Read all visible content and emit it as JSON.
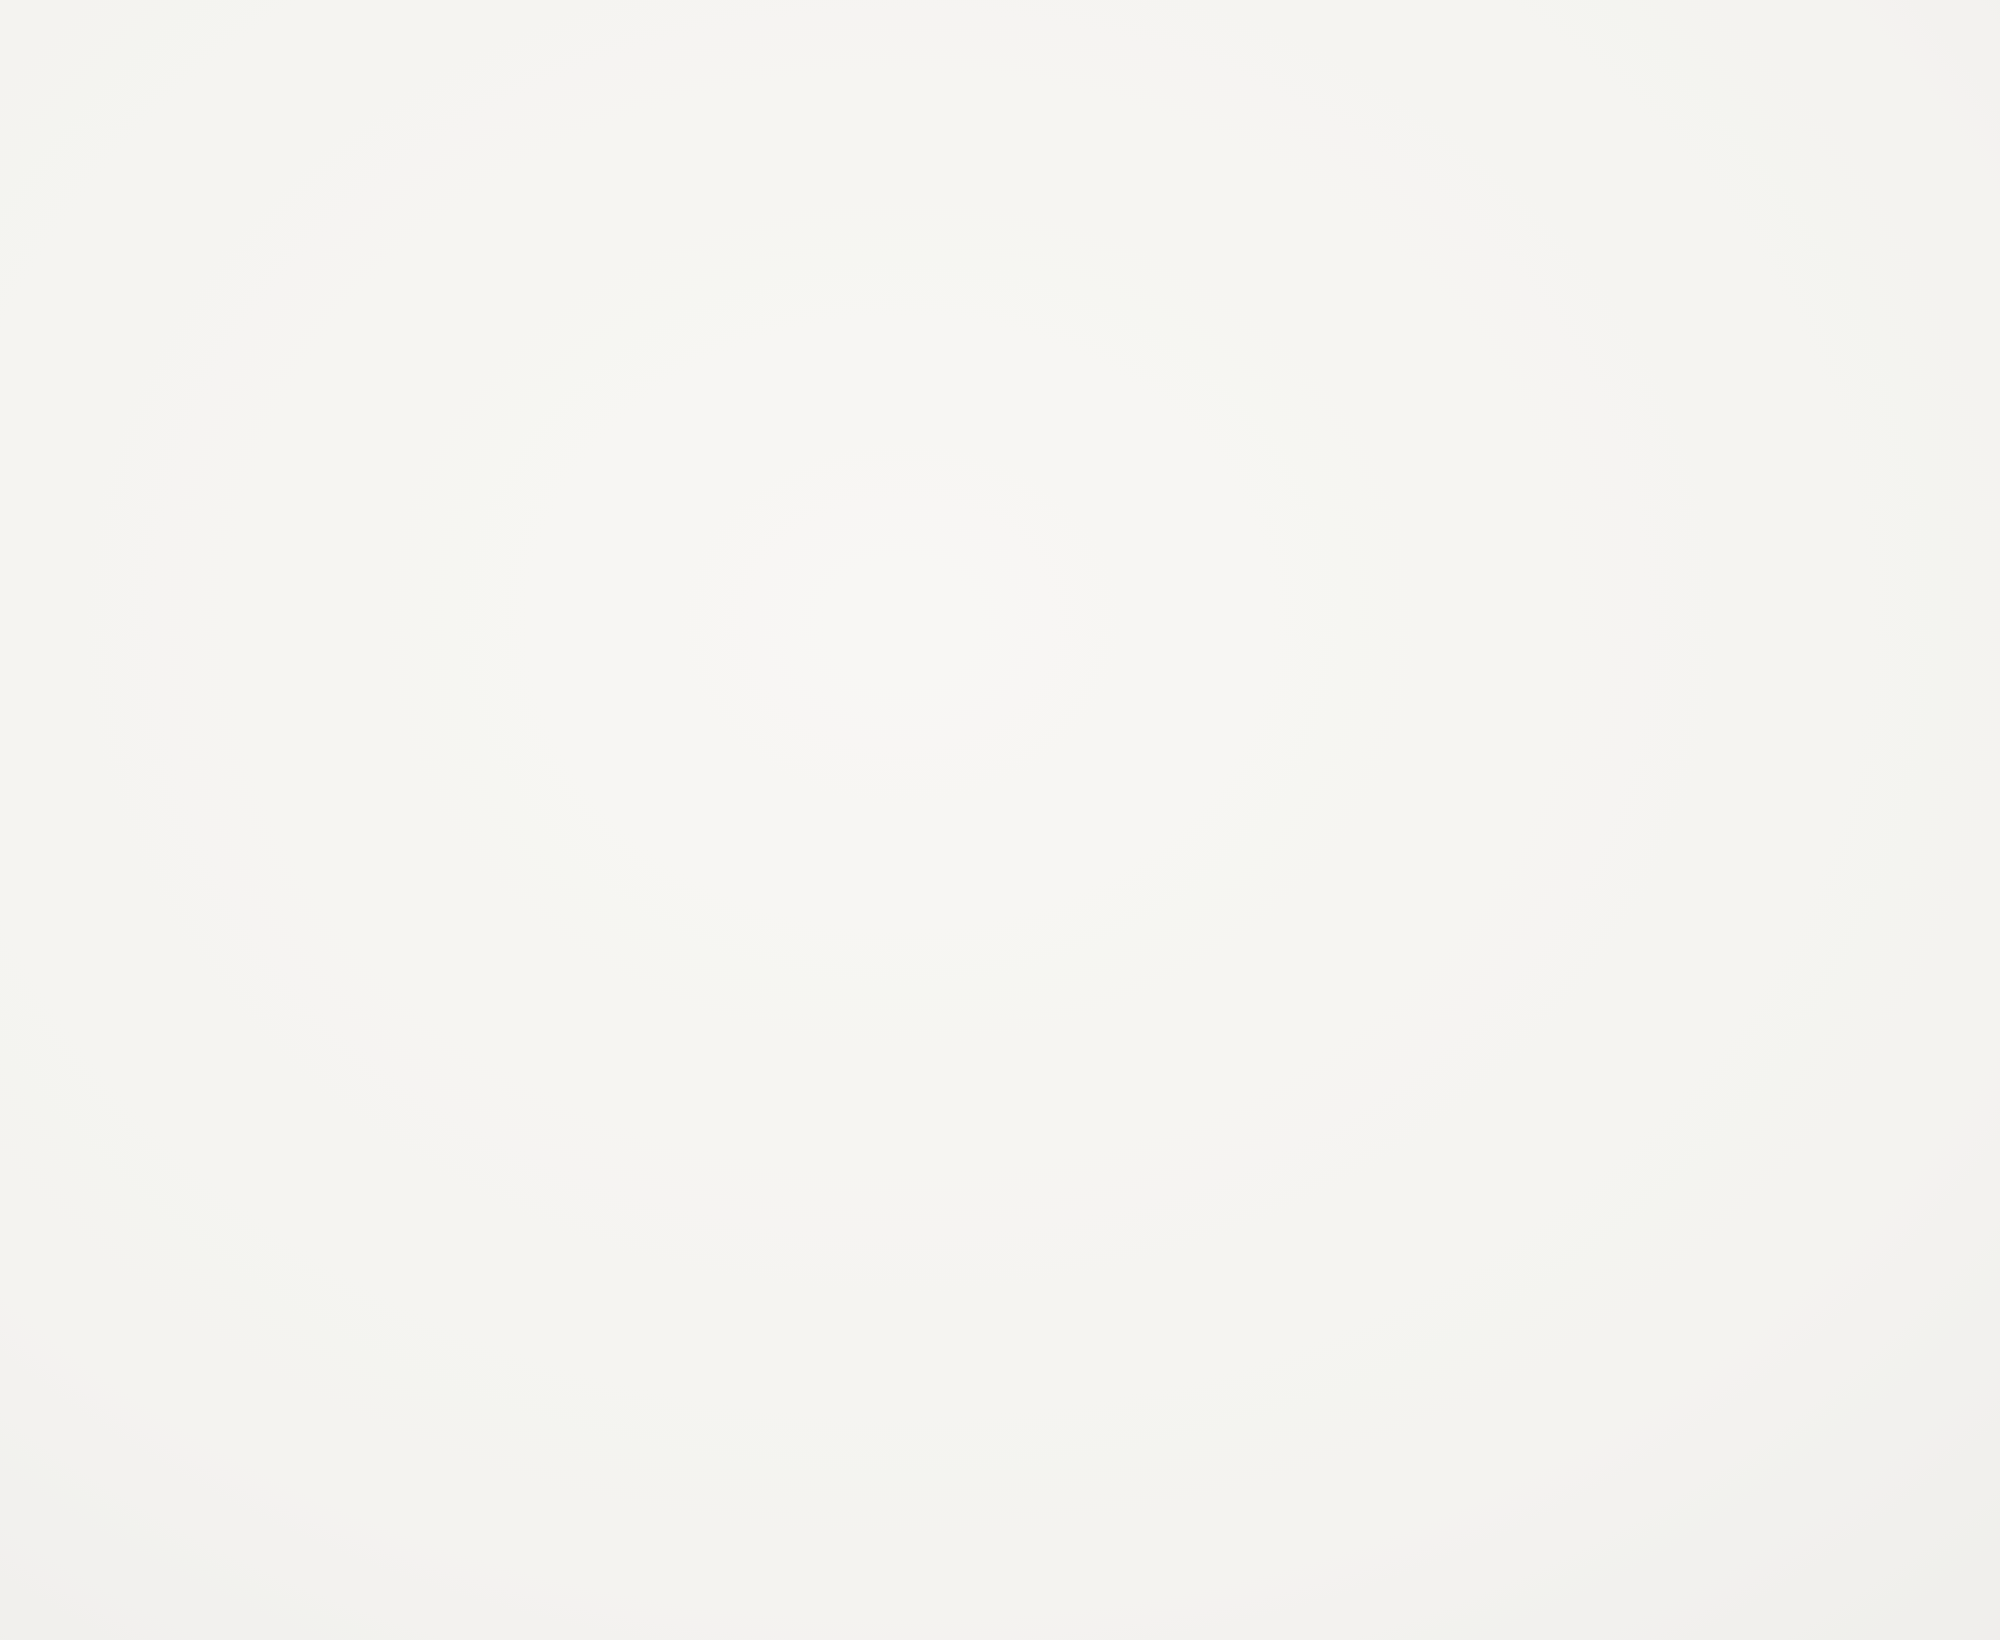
{
  "document": {
    "title": "Hand-drawn front elevation sketch of a French country style house",
    "medium": "graphite pencil with black ink marker accents on white drawing paper",
    "visible_text": []
  },
  "palette": {
    "paper": "#f5f4f1",
    "paper_light": "#f8f7f5",
    "pencil_dark": "#383838",
    "pencil": "#4e4e4e",
    "pencil_light": "#7b7b79",
    "pencil_faint": "#aeaaa6",
    "ink": "#161616",
    "smudge": "#dddcd9"
  },
  "roof": {
    "ridge": {
      "x1": 933,
      "y": 432,
      "x2": 1086,
      "faint_x2": 1228
    },
    "edges": [
      [
        933,
        435,
        688,
        886,
        "m"
      ],
      [
        941,
        440,
        698,
        890,
        "m"
      ],
      [
        521,
        506,
        66,
        936,
        "m"
      ],
      [
        531,
        511,
        78,
        941,
        "m"
      ],
      [
        312,
        646,
        404,
        646,
        "m"
      ],
      [
        312,
        646,
        172,
        834,
        "m"
      ],
      [
        321,
        651,
        183,
        839,
        "l"
      ],
      [
        172,
        834,
        104,
        922,
        "l"
      ],
      [
        520,
        504,
        908,
        504,
        "m"
      ],
      [
        1086,
        433,
        1232,
        657,
        "m"
      ],
      [
        1232,
        657,
        1327,
        803,
        "l"
      ],
      [
        1228,
        433,
        1680,
        948,
        "l"
      ],
      [
        1447,
        658,
        1277,
        950,
        "m"
      ],
      [
        1447,
        658,
        1659,
        658,
        "m"
      ],
      [
        1659,
        658,
        1930,
        941,
        "m"
      ],
      [
        1570,
        800,
        1623,
        906,
        "l"
      ],
      [
        1757,
        795,
        1799,
        906,
        "l"
      ],
      [
        1512,
        760,
        1552,
        905,
        "l"
      ],
      [
        876,
        500,
        756,
        720,
        "l"
      ],
      [
        840,
        565,
        735,
        760,
        "l"
      ],
      [
        1005,
        470,
        1128,
        660,
        "l"
      ],
      [
        1040,
        525,
        1155,
        700,
        "l"
      ],
      [
        640,
        680,
        430,
        888,
        "l"
      ]
    ],
    "planes": {
      "left": {
        "clip": [
          [
            40,
            945
          ],
          [
            520,
            500
          ],
          [
            945,
            428
          ],
          [
            700,
            890
          ],
          [
            420,
            945
          ]
        ],
        "y1": 505,
        "y2": 938,
        "step": 57,
        "x1": 30,
        "x2": 960
      },
      "center": {
        "clip": [
          [
            688,
            890
          ],
          [
            935,
            432
          ],
          [
            1088,
            432
          ],
          [
            1234,
            662
          ],
          [
            1152,
            955
          ],
          [
            618,
            955
          ]
        ],
        "y1": 466,
        "y2": 948,
        "step": 54,
        "x1": 600,
        "x2": 1250
      },
      "rightback": {
        "clip": [
          [
            1088,
            430
          ],
          [
            1228,
            433
          ],
          [
            1930,
            941
          ],
          [
            1662,
            950
          ],
          [
            1232,
            662
          ]
        ],
        "y1": 470,
        "y2": 944,
        "step": 56,
        "x1": 1080,
        "x2": 1935
      },
      "rightwing": {
        "clip": [
          [
            1447,
            660
          ],
          [
            1659,
            660
          ],
          [
            1930,
            943
          ],
          [
            1280,
            952
          ]
        ],
        "y1": 678,
        "y2": 938,
        "step": 50,
        "x1": 1270,
        "x2": 1935
      }
    }
  },
  "eaves": {
    "lines": [
      [
        58,
        936,
        560,
        936,
        "m"
      ],
      [
        58,
        948,
        560,
        948,
        "m"
      ],
      [
        52,
        928,
        92,
        928,
        "l"
      ],
      [
        52,
        928,
        52,
        950,
        "l"
      ],
      [
        1067,
        940,
        1930,
        940,
        "m"
      ],
      [
        1067,
        952,
        1930,
        952,
        "m"
      ],
      [
        1930,
        940,
        1937,
        963,
        "m"
      ],
      [
        618,
        850,
        1085,
        850,
        "m"
      ],
      [
        618,
        872,
        1085,
        872,
        "m"
      ],
      [
        600,
        890,
        1085,
        890,
        "f"
      ]
    ],
    "stringcourse_tick_segments": [
      [
        620,
        664
      ],
      [
        746,
        790
      ],
      [
        874,
        922
      ],
      [
        1006,
        1083
      ]
    ],
    "corners": [
      [
        66,
        950,
        66,
        1120,
        1.5
      ],
      [
        560,
        948,
        560,
        1100,
        1.5
      ],
      [
        1082,
        888,
        1082,
        1160,
        1.5
      ],
      [
        1686,
        954,
        1686,
        1205,
        2.0
      ],
      [
        1692,
        954,
        1692,
        1205,
        1.0
      ],
      [
        1910,
        954,
        1910,
        1198,
        2.0
      ],
      [
        1918,
        954,
        1918,
        1196,
        1.1
      ],
      [
        618,
        852,
        618,
        938,
        1.0
      ]
    ]
  },
  "dormers": [
    {
      "name": "left-wing-dormer",
      "cx": 332,
      "peak": 845,
      "spring": 900,
      "base": 958,
      "w": 96,
      "win": 56,
      "block": false
    },
    {
      "name": "center-dormer-1",
      "cx": 705,
      "peak": 772,
      "spring": 815,
      "base": 905,
      "w": 80,
      "win": 50,
      "block": true
    },
    {
      "name": "center-dormer-2",
      "cx": 831,
      "peak": 772,
      "spring": 815,
      "base": 905,
      "w": 80,
      "win": 50,
      "block": true
    },
    {
      "name": "center-dormer-3",
      "cx": 964,
      "peak": 772,
      "spring": 815,
      "base": 905,
      "w": 80,
      "win": 50,
      "block": true
    },
    {
      "name": "right-dormer",
      "cx": 1150,
      "peak": 845,
      "spring": 900,
      "base": 958,
      "w": 96,
      "win": 56,
      "block": false
    }
  ],
  "windows": [
    {
      "name": "left-wing-window",
      "frame": [
        197,
        985,
        102,
        157
      ],
      "cols": 4,
      "rows": 3,
      "header": [
        197,
        963,
        102,
        22
      ],
      "shutters": [
        [
          150,
          985,
          46,
          165,
          -1
        ],
        [
          300,
          985,
          46,
          165,
          1
        ]
      ],
      "sill": true
    },
    {
      "name": "right-center-window",
      "frame": [
        1150,
        988,
        106,
        160
      ],
      "cols": 4,
      "rows": 3,
      "header": [
        1150,
        965,
        106,
        23
      ],
      "shutters": [
        [
          1103,
          990,
          45,
          162,
          -1
        ],
        [
          1258,
          990,
          45,
          162,
          1
        ]
      ],
      "sill": true
    },
    {
      "name": "right-wing-window",
      "frame": [
        1528,
        982,
        70,
        168
      ],
      "cols": 2,
      "rows": 3,
      "header": [
        1528,
        960,
        70,
        22
      ],
      "shutters": [
        [
          1488,
          984,
          38,
          168,
          -1
        ],
        [
          1600,
          984,
          38,
          168,
          1
        ]
      ],
      "sill": true,
      "hinges": true
    },
    {
      "name": "far-right-window",
      "frame": [
        1757,
        965,
        63,
        120
      ],
      "cols": 2,
      "rows": 2,
      "header": [
        1757,
        945,
        63,
        20
      ],
      "shutters": [],
      "sill": true
    }
  ],
  "arch_window": {
    "name": "grand-arched-window",
    "band_out": [
      420,
      774,
      1010,
      878
    ],
    "band_in": [
      446,
      748,
      1010,
      905
    ],
    "x1": 440,
    "x2": 754,
    "spring": 1010,
    "bottom": 1235,
    "cols": [
      452,
      528,
      604,
      680
    ],
    "pane_w": 62,
    "rows": [
      [
        1047,
        1105
      ],
      [
        1117,
        1172
      ],
      [
        1184,
        1232
      ]
    ],
    "r1_tops": [
      992,
      958,
      958,
      992
    ],
    "r1_bottom": 1035,
    "shutters": [
      [
        380,
        1012,
        42,
        168,
        -1
      ],
      [
        774,
        1012,
        62,
        173,
        1
      ]
    ],
    "construction": [
      [
        376,
        1180,
        520,
        930
      ],
      [
        700,
        1140,
        800,
        980
      ]
    ]
  },
  "door": {
    "name": "entry-door",
    "fan_out": [
      897,
      1035,
      1010,
      928
    ],
    "fan_in": [
      920,
      1012,
      1010,
      962
    ],
    "frame_x1": 922,
    "frame_x2": 1005,
    "spring": 1012,
    "head_crown": 980,
    "bottom": 1185,
    "leaf_x1": 933,
    "leaf_x2": 996,
    "cols": [
      938,
      968
    ],
    "pane_w": 24,
    "rows": [
      [
        995,
        1052
      ],
      [
        1062,
        1112
      ],
      [
        1122,
        1162
      ]
    ],
    "threshold": [
      [
        912,
        1185,
        1016,
        1185
      ],
      [
        905,
        1193,
        1023,
        1193
      ]
    ],
    "lantern": {
      "box": [
        862,
        985,
        26,
        42
      ],
      "stem_top": 952
    },
    "hatch": [
      [
        930,
        1000,
        955,
        975
      ],
      [
        944,
        1008,
        975,
        970
      ],
      [
        958,
        1012,
        995,
        972
      ],
      [
        975,
        1012,
        1008,
        980
      ]
    ]
  },
  "brick_regions": [
    [
      64,
      955,
      84,
      195,
      13
    ],
    [
      352,
      958,
      80,
      192,
      13
    ],
    [
      560,
      950,
      58,
      145,
      10
    ],
    [
      600,
      893,
      70,
      110,
      8
    ],
    [
      620,
      876,
      465,
      50,
      4
    ],
    [
      838,
      960,
      60,
      48,
      3
    ],
    [
      1040,
      960,
      58,
      44,
      3
    ],
    [
      1316,
      978,
      104,
      190,
      12
    ],
    [
      1400,
      958,
      86,
      210,
      13
    ],
    [
      1640,
      958,
      42,
      130,
      9
    ],
    [
      1717,
      955,
      38,
      135,
      11
    ],
    [
      1822,
      955,
      38,
      135,
      11
    ],
    [
      1740,
      1092,
      100,
      85,
      6
    ],
    [
      1860,
      960,
      52,
      95,
      7
    ]
  ],
  "course_stacks": [
    [
      852,
      920,
      1022,
      1170,
      16,
      18
    ],
    [
      1008,
      1096,
      1002,
      1174,
      14,
      26
    ],
    [
      1848,
      1912,
      1062,
      1196,
      17,
      24
    ]
  ],
  "construction_lines": [
    [
      152,
      698,
      348,
      546
    ],
    [
      1058,
      352,
      1140,
      428
    ],
    [
      823,
      2,
      823,
      162
    ],
    [
      1113,
      0,
      1113,
      300
    ],
    [
      763,
      592,
      763,
      930
    ],
    [
      964,
      620,
      964,
      1008
    ],
    [
      1732,
      1078,
      1862,
      975
    ],
    [
      1317,
      1143,
      1365,
      1080
    ]
  ],
  "shrubs": {
    "bands": [
      {
        "x1": 36,
        "x2": 912,
        "top": 1128,
        "bottom": 1227
      },
      {
        "x1": 1020,
        "x2": 1612,
        "top": 1130,
        "bottom": 1225
      },
      {
        "x1": 1652,
        "x2": 1712,
        "top": 1162,
        "bottom": 1222
      }
    ]
  },
  "walkway": {
    "left_edge": [
      [
        893,
        1198
      ],
      [
        878,
        1243
      ],
      [
        842,
        1295
      ],
      [
        800,
        1334
      ]
    ],
    "left_edge2": [
      [
        900,
        1198
      ],
      [
        885,
        1246
      ],
      [
        850,
        1300
      ],
      [
        807,
        1340
      ]
    ],
    "right_edge": [
      [
        1047,
        1198
      ],
      [
        1062,
        1248
      ],
      [
        1102,
        1312
      ],
      [
        1152,
        1367
      ]
    ],
    "right_edge2": [
      [
        1040,
        1198
      ],
      [
        1056,
        1250
      ],
      [
        1094,
        1315
      ],
      [
        1143,
        1370
      ]
    ],
    "right_faint": [
      [
        1152,
        1367
      ],
      [
        1230,
        1472
      ]
    ],
    "steps": [
      [
        908,
        1212,
        1040,
        1212
      ],
      [
        902,
        1228,
        1048,
        1228
      ]
    ],
    "tick_marks": [
      [
        1162,
        1380
      ],
      [
        1196,
        1426
      ],
      [
        1222,
        1458
      ]
    ]
  },
  "side_path": {
    "edge1": [
      [
        1418,
        1352
      ],
      [
        1505,
        1292
      ],
      [
        1600,
        1234
      ],
      [
        1668,
        1196
      ]
    ],
    "edge2": [
      [
        1426,
        1360
      ],
      [
        1512,
        1300
      ],
      [
        1607,
        1242
      ],
      [
        1676,
        1204
      ]
    ],
    "tail": [
      [
        1702,
        1220
      ],
      [
        1714,
        1252
      ],
      [
        1725,
        1285
      ]
    ]
  },
  "ground_lines": [
    [
      36,
      1192,
      905,
      1192
    ],
    [
      1052,
      1194,
      1930,
      1198
    ]
  ],
  "speckle_regions": [
    [
      830,
      1215,
      290,
      150,
      46
    ],
    [
      1430,
      1195,
      540,
      95,
      40
    ],
    [
      1700,
      1245,
      250,
      60,
      16
    ],
    [
      700,
      1245,
      120,
      70,
      8
    ],
    [
      40,
      980,
      40,
      90,
      6
    ]
  ],
  "smudges": [
    [
      150,
      700,
      345,
      545
    ],
    [
      1062,
      356,
      1136,
      430
    ],
    [
      245,
      975,
      260,
      1060
    ]
  ],
  "dust": [
    [
      123,
      142
    ],
    [
      615,
      418
    ],
    [
      876,
      40
    ],
    [
      1458,
      118
    ],
    [
      1878,
      457
    ],
    [
      43,
      888
    ],
    [
      1915,
      1107
    ],
    [
      1345,
      62
    ]
  ]
}
